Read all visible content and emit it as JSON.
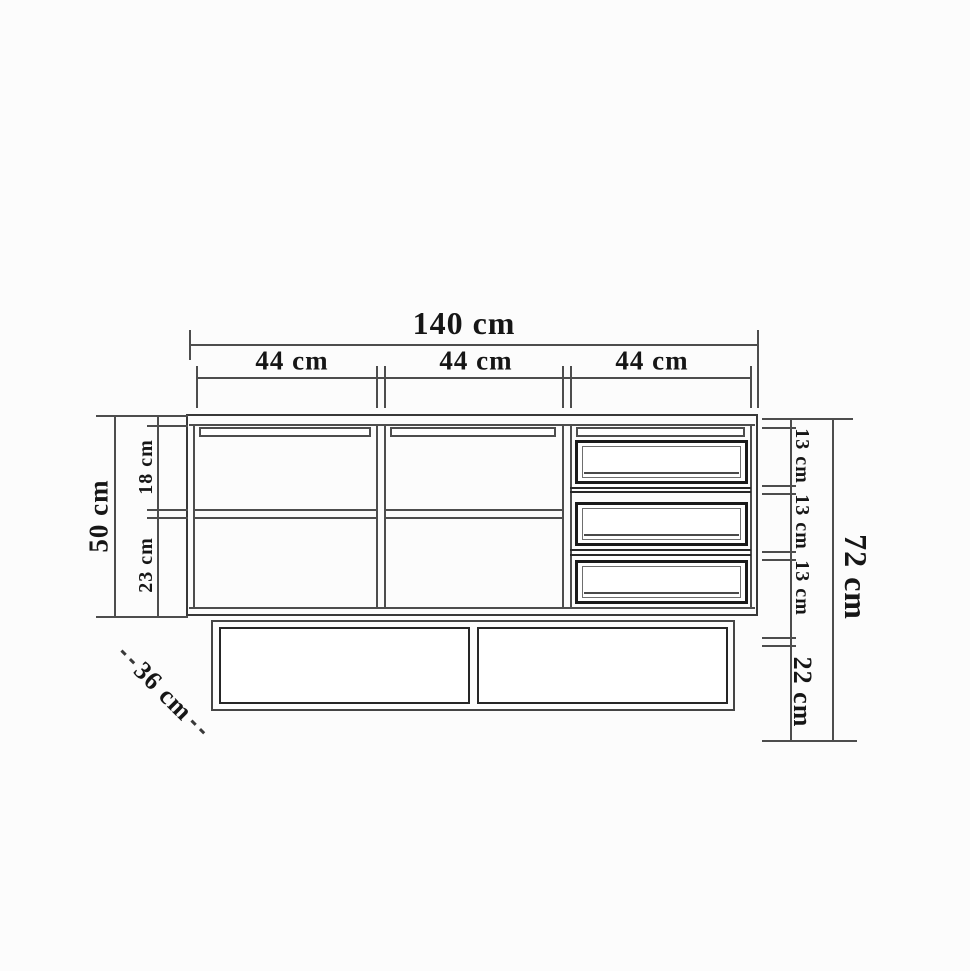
{
  "labels": {
    "total_width": "140 cm",
    "sections": [
      "44 cm",
      "44 cm",
      "44 cm"
    ],
    "body_height": "50 cm",
    "upper_compartment": "18 cm",
    "lower_compartment": "23 cm",
    "drawers": [
      "13 cm",
      "13 cm",
      "13 cm"
    ],
    "total_height": "72 cm",
    "base_height": "22 cm",
    "depth": "36 cm"
  },
  "colors": {
    "background": "#fcfcfc",
    "structure_line": "#4d4d4d",
    "heavy_line": "#1a1a1a",
    "dimension_line": "#4d4d4d",
    "text": "#161616"
  }
}
